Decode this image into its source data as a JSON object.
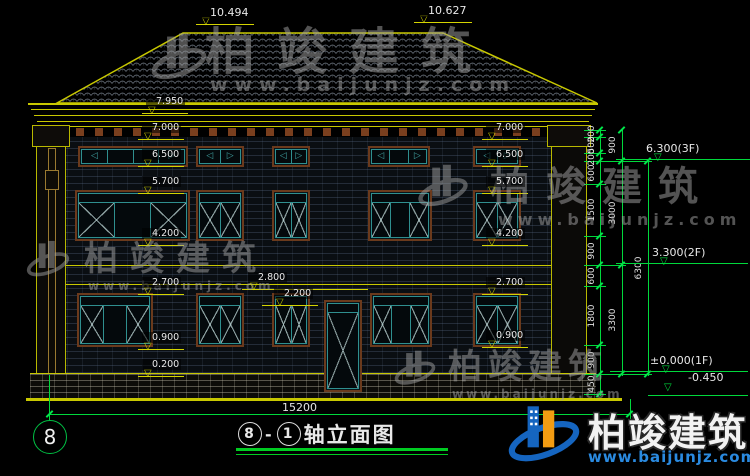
{
  "watermark": {
    "brand": "柏竣建筑",
    "url": "www.baijunjz.com"
  },
  "title": {
    "axis_start": "8",
    "separator": "-",
    "axis_end": "1",
    "text": "轴立面图"
  },
  "axis_bubble": {
    "label": "8"
  },
  "dims": {
    "ridge_left": "10.494",
    "ridge_right": "10.627",
    "eave": "7.950",
    "left_levels": [
      "7.000",
      "6.500",
      "5.700",
      "4.200",
      "2.700",
      "0.900",
      "0.200"
    ],
    "right_levels": [
      "7.000",
      "6.500",
      "5.700",
      "4.200",
      "2.700",
      "0.900"
    ],
    "center_levels": [
      "2.800",
      "2.200"
    ],
    "total_width": "15200",
    "chain_inner": [
      "200",
      "500",
      "200",
      "600",
      "1500",
      "900",
      "600",
      "1800",
      "900",
      "450"
    ],
    "chain_mid": [
      "900",
      "3000",
      "3300"
    ],
    "chain_outer": [
      "6300"
    ],
    "floor_marks": {
      "f3": "6.300(3F)",
      "f2": "3.300(2F)",
      "f1": "±0.000(1F)",
      "grade": "-0.450"
    }
  },
  "colors": {
    "line_yellow": "#c8c800",
    "dim_green": "#00d93c",
    "frame_teal": "#2f8f8f",
    "surround_brown": "#6b3a1c",
    "text": "#e8e8e8",
    "logo_blue": "#1565c0",
    "logo_orange": "#f39c12"
  }
}
